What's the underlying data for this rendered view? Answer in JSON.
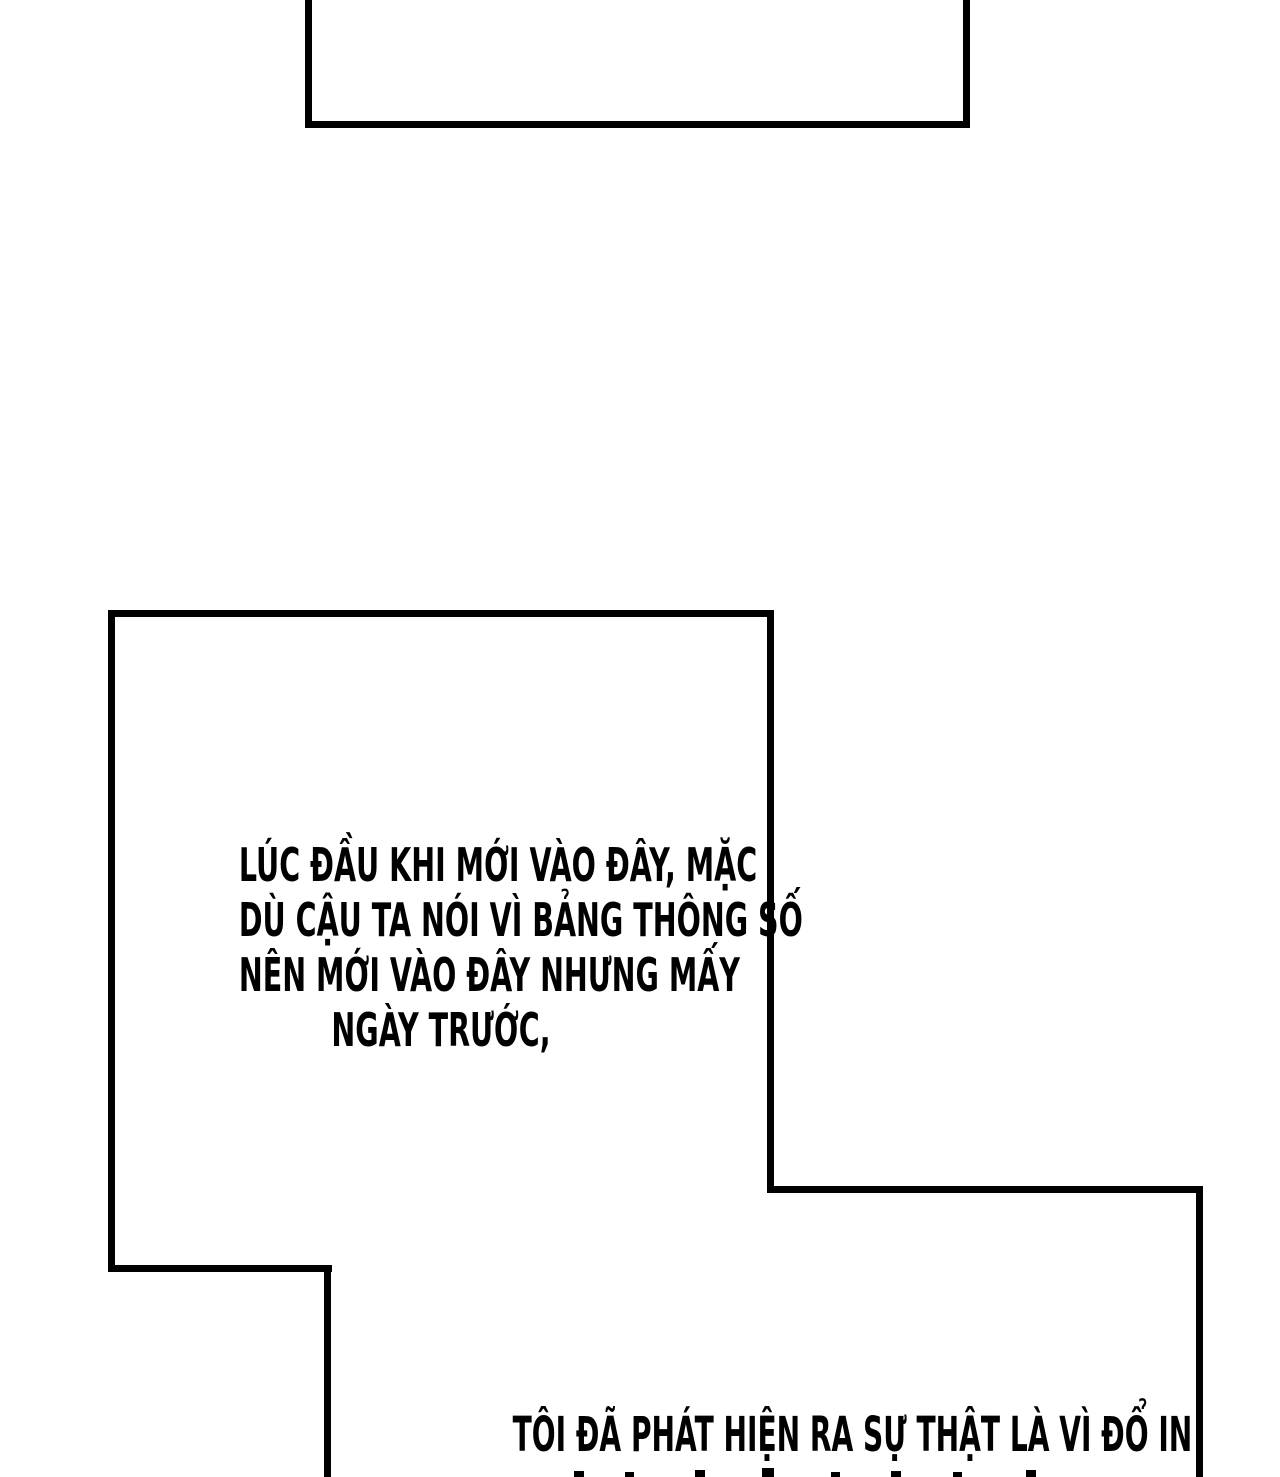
{
  "page": {
    "kind": "comic-webtoon-page",
    "background_color": "#ffffff",
    "ink_color": "#000000"
  },
  "panels": {
    "top_partial": {
      "content": ""
    },
    "middle": {
      "dialogue_lines": [
        "LÚC ĐẦU KHI MỚI VÀO ĐÂY, MẶC",
        "DÙ CẬU TA NÓI VÌ BẢNG THÔNG SỐ",
        "NÊN MỚI VÀO ĐÂY NHƯNG MẤY",
        "NGÀY TRƯỚC,"
      ]
    },
    "bottom": {
      "dialogue_line": "TÔI ĐÃ PHÁT HIỆN RA SỰ THẬT LÀ VÌ ĐỔ IN",
      "next_line_cut_off": true
    }
  }
}
